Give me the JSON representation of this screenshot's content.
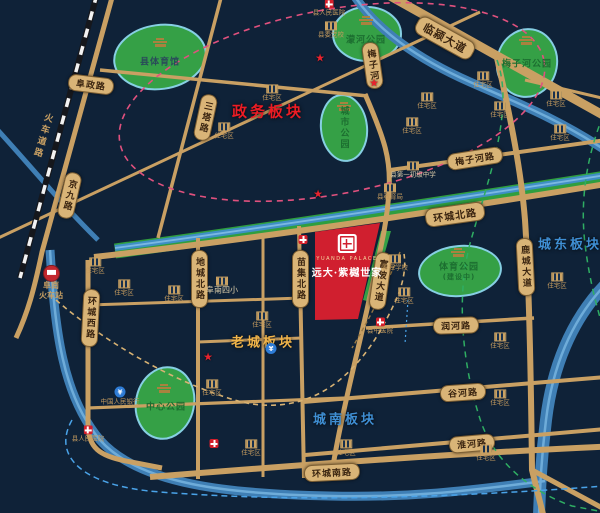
{
  "colors": {
    "bg_navy": "#0f2238",
    "road_gold": "#c9a063",
    "water_blue": "#3f7fb5",
    "park_green": "#35a046",
    "parcel_red": "#d01f2f",
    "district_red": "#ed1c24",
    "district_gold": "#f0b44a",
    "district_blue": "#3f8fd4"
  },
  "icons": {
    "star": "★",
    "bank": "¥"
  },
  "project": {
    "name_en": "YUANDA PALACE",
    "name_cn": "远大·紫樾世家"
  },
  "districts": {
    "zhengwu": "政务板块",
    "laocheng": "老城板块",
    "chengnan": "城南板块",
    "chengdong": "城东板块"
  },
  "roads": {
    "fuzheng": "阜政路",
    "linying": "临颍大道",
    "santa": "三塔路",
    "jingjiu": "京九路",
    "huanchengxi": "环城西路",
    "dicheng": "地城北路",
    "miaoji": "苗集北路",
    "fupi": "富陂大道",
    "lucheng": "鹿城大道",
    "huanchengbei": "环城北路",
    "meizihe_rd": "梅子河路",
    "runhe": "润河路",
    "guhe": "谷河路",
    "huaihe": "淮河路",
    "huanchengnan": "环城南路",
    "railway": "火车道路",
    "meizihe_river": "梅子河"
  },
  "station": {
    "line1": "阜南",
    "line2": "火车站"
  },
  "parks": {
    "tiyuguan": "县体育馆",
    "menghe": "濛河公园",
    "meizihe": "梅子河公园",
    "chengshi": "城市公园",
    "zhongxin": "中心公园",
    "tiyu": "体育公园",
    "tiyu_status": "(建设中)"
  },
  "pois": [
    {
      "type": "school",
      "label": "县委党校"
    },
    {
      "type": "hospital",
      "label": "县人民医院"
    },
    {
      "type": "residential",
      "label": "住宅区"
    },
    {
      "type": "residential",
      "label": "住宅区"
    },
    {
      "type": "school",
      "label": "县第一初级中学"
    },
    {
      "type": "school",
      "label": "县教育局"
    },
    {
      "type": "residential",
      "label": "住宅区"
    },
    {
      "type": "residential",
      "label": "住宅区"
    },
    {
      "type": "residential",
      "label": "住宅区"
    },
    {
      "type": "residential",
      "label": "住宅区"
    },
    {
      "type": "residential",
      "label": "住宅区"
    },
    {
      "type": "residential",
      "label": "住宅区"
    },
    {
      "type": "school",
      "label": "阜南四小"
    },
    {
      "type": "residential",
      "label": "住宅区"
    },
    {
      "type": "residential",
      "label": "住宅区"
    },
    {
      "type": "residential",
      "label": "住宅区"
    },
    {
      "type": "residential",
      "label": "住宅区"
    },
    {
      "type": "bank",
      "label": "中国人民银行"
    },
    {
      "type": "hospital",
      "label": "县人民医院"
    },
    {
      "type": "residential",
      "label": "住宅区"
    },
    {
      "type": "school",
      "label": "春晖学校"
    },
    {
      "type": "hospital",
      "label": "县中医院"
    },
    {
      "type": "residential",
      "label": "住宅区"
    },
    {
      "type": "residential",
      "label": "住宅区"
    },
    {
      "type": "residential",
      "label": "住宅区"
    },
    {
      "type": "residential",
      "label": "住宅区"
    },
    {
      "type": "residential",
      "label": "住宅区"
    },
    {
      "type": "residential",
      "label": "住宅区"
    },
    {
      "type": "residential",
      "label": "住宅区"
    },
    {
      "type": "star",
      "label": ""
    },
    {
      "type": "star",
      "label": ""
    },
    {
      "type": "star",
      "label": ""
    },
    {
      "type": "star",
      "label": ""
    },
    {
      "type": "bank",
      "label": ""
    },
    {
      "type": "hospital",
      "label": ""
    },
    {
      "type": "hospital",
      "label": ""
    }
  ]
}
